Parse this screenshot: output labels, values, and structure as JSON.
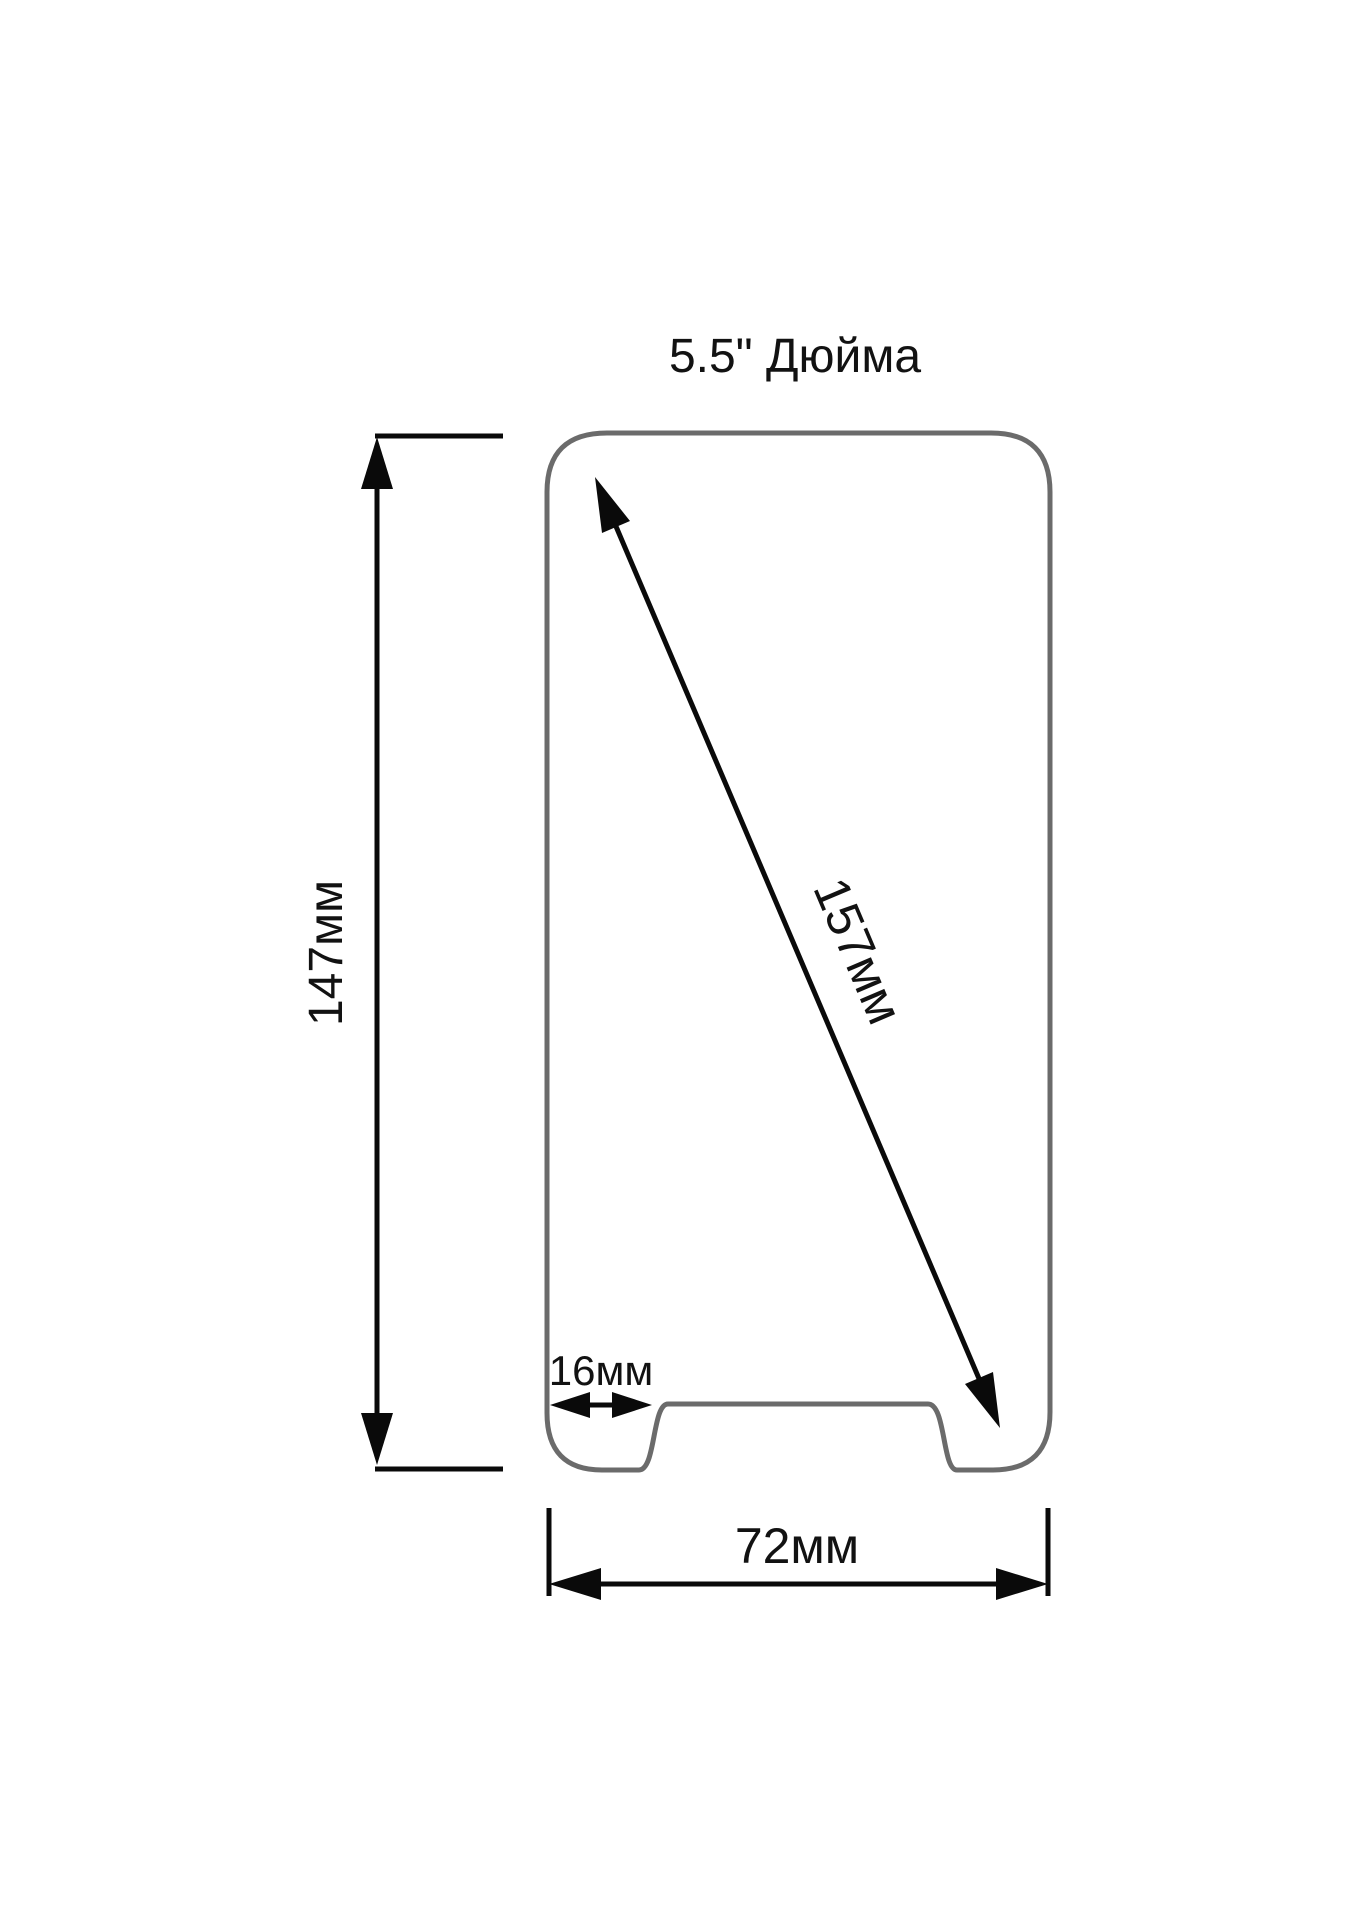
{
  "diagram": {
    "title": "5.5\" Дюйма",
    "dimensions": {
      "height": {
        "label": "147мм",
        "value_mm": 147
      },
      "diagonal": {
        "label": "157мм",
        "value_mm": 157
      },
      "notch_offset": {
        "label": "16мм",
        "value_mm": 16
      },
      "width": {
        "label": "72мм",
        "value_mm": 72
      }
    },
    "colors": {
      "outline": "#6b6b6b",
      "dimension": "#0a0a0a",
      "text": "#121212",
      "background": "#ffffff"
    }
  }
}
